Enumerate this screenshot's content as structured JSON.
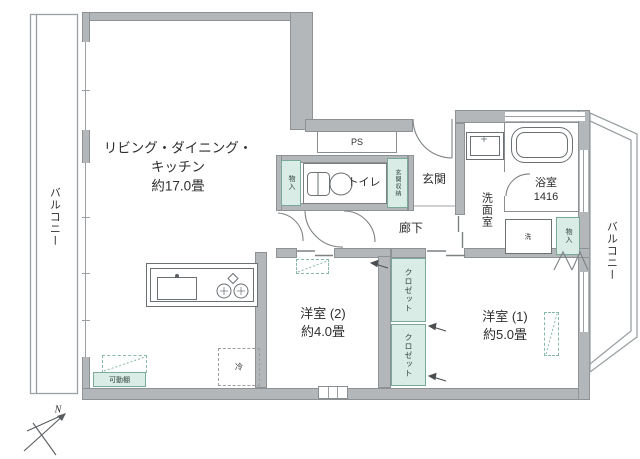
{
  "labels": {
    "balcony_left": "バルコニー",
    "balcony_right": "バルコニー",
    "ldk1": "リビング・ダイニング・",
    "ldk2": "キッチン",
    "ldk3": "約17.0畳",
    "ps": "PS",
    "storage_small_left": "物入",
    "toilet": "トイレ",
    "entrance_storage": "玄関収納",
    "entrance": "玄関",
    "hallway": "廊下",
    "washroom": "洗面室",
    "bathroom_name": "浴室",
    "bathroom_size": "1416",
    "laundry": "洗",
    "storage_small_right": "物入",
    "closet_upper": "クロゼット",
    "closet_lower": "クロゼット",
    "western2_name": "洋室 (2)",
    "western2_size": "約4.0畳",
    "western1_name": "洋室 (1)",
    "western1_size": "約5.0畳",
    "fridge": "冷",
    "movable_shelf": "可動棚",
    "north": "N"
  },
  "colors": {
    "wall_fill": "#b4b7ba",
    "wall_outline": "#8e9295",
    "accent_fill": "#d9ece5",
    "accent_border": "#7aa89a",
    "linework": "#7d8184",
    "text": "#2e2e2e"
  }
}
